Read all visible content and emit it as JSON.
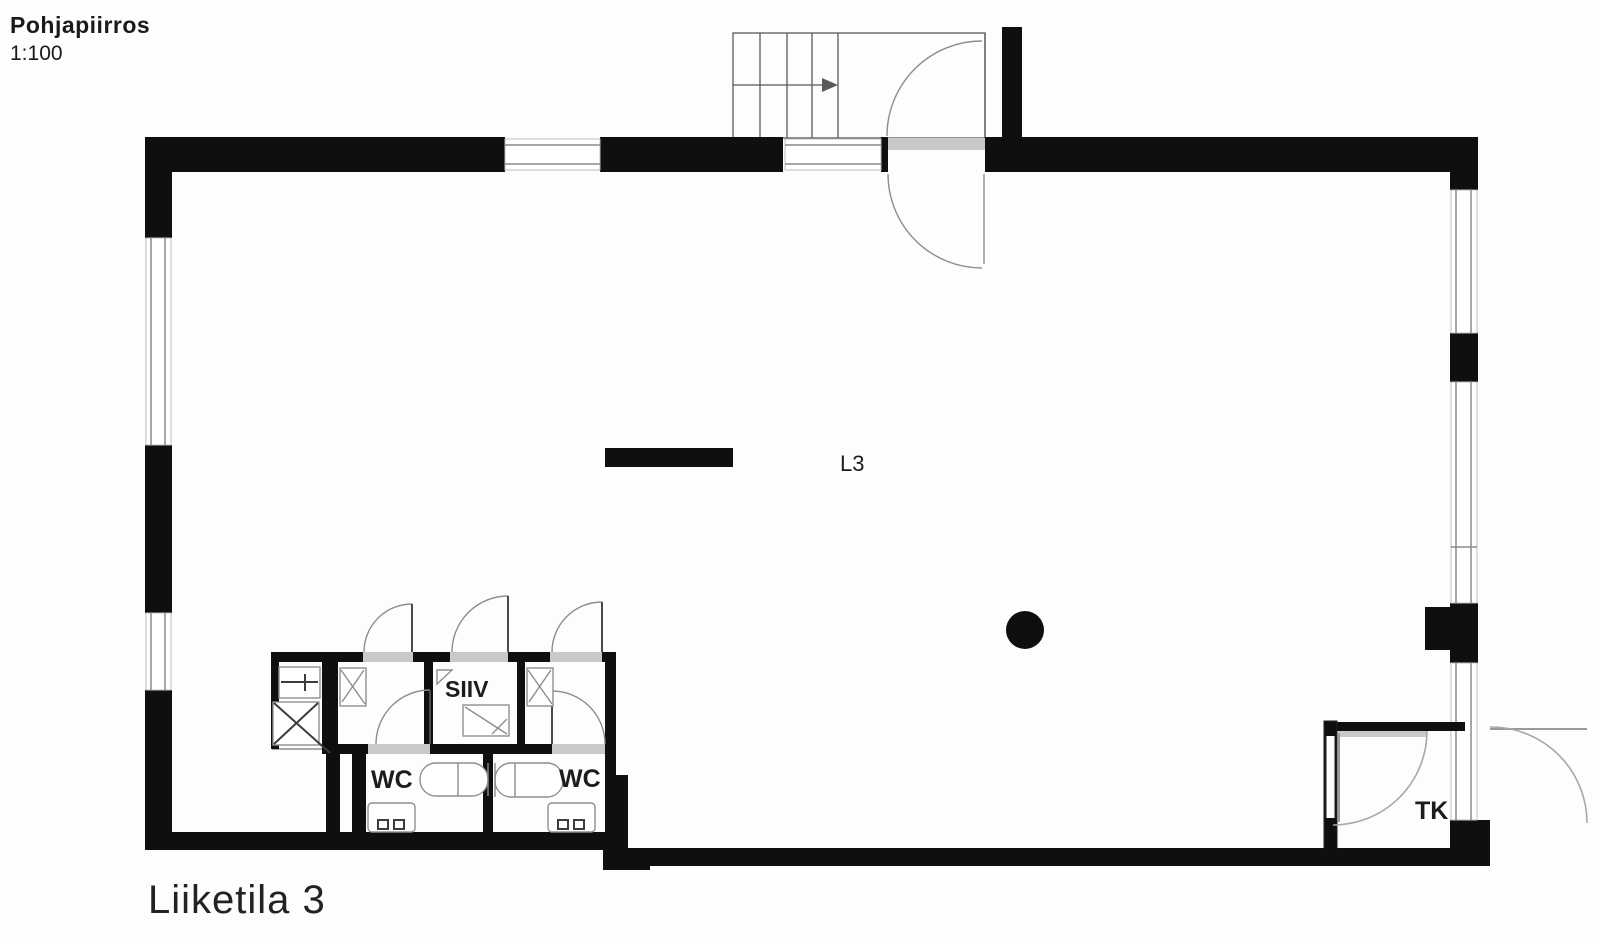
{
  "drawing": {
    "title": "Pohjapiirros",
    "scale": "1:100",
    "caption": "Liiketila 3",
    "rooms": {
      "main_label": "L3",
      "cleaning_label": "SIIV",
      "wc1_label": "WC",
      "wc2_label": "WC",
      "vestibule_label": "TK"
    },
    "colors": {
      "wall": "#0f0f0f",
      "opening": "#c9c9c9",
      "ink": "#1a1a1a"
    }
  }
}
